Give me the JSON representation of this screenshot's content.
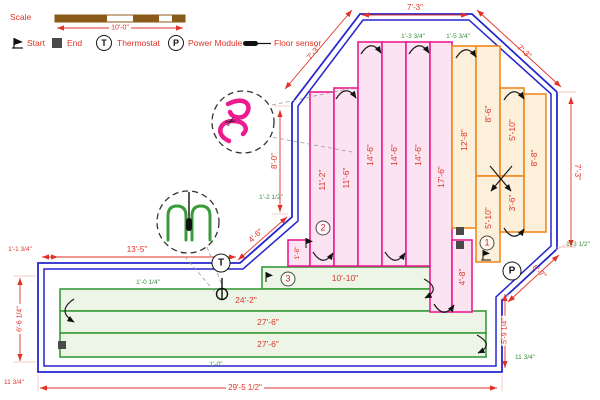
{
  "legend": {
    "scale_label": "Scale",
    "scale_value": "10'-0\"",
    "start": "Start",
    "end": "End",
    "thermostat": "Thermostat",
    "thermostat_symbol": "T",
    "power_module": "Power Module",
    "power_symbol": "P",
    "floor_sensor": "Floor sensor"
  },
  "zones": {
    "pink": {
      "number": "2",
      "runs": [
        "1'-8\"",
        "11'-2\"",
        "11'-6\"",
        "14'-6\"",
        "14'-6\"",
        "14'-6\"",
        "17'-6\"",
        "4'-8\""
      ]
    },
    "orange": {
      "number": "1",
      "runs": [
        "12'-8\"",
        "8'-6\"",
        "5'-10\"",
        "5'-10\"",
        "3'-6\"",
        "8'-8\""
      ]
    },
    "green": {
      "number": "3",
      "runs": [
        "10'-10\"",
        "24'-2\"",
        "27'-6\"",
        "27'-6\""
      ]
    }
  },
  "dims_red": {
    "top": "7'-3\"",
    "top_left_diag": "7'-3\"",
    "top_right_diag": "7'-3\"",
    "right": "7'-3\"",
    "lower_right_diag": "6'-7\"",
    "bottom_right": "5'-9 1/4\"",
    "bottom": "29'-5 1/2\"",
    "left": "6'-6 1/4\"",
    "left_top": "1'-1 3/4\"",
    "left_bottom": "11 3/4\"",
    "left_wall": "13'-5\"",
    "small_diag": "4'-6\"",
    "mid_left": "8'-0\""
  },
  "dims_green": {
    "top_a": "1'-3 3/4\"",
    "top_b": "1'-5 3/4\"",
    "mid_left": "1'-2 1/2\"",
    "right": "1'-3 1/2\"",
    "green_top": "1'-0 1/4\"",
    "bottom": "1'-0\"",
    "bottom_right": "11 3/4\""
  },
  "colors": {
    "wall": "#2525cf",
    "dimension": "#e23227",
    "sub_dimension": "#3a8f3f",
    "zone_pink": "#ec1c90",
    "zone_orange": "#f2891f",
    "zone_green": "#3a9b3a",
    "scale_bar": "#8a5a19"
  }
}
